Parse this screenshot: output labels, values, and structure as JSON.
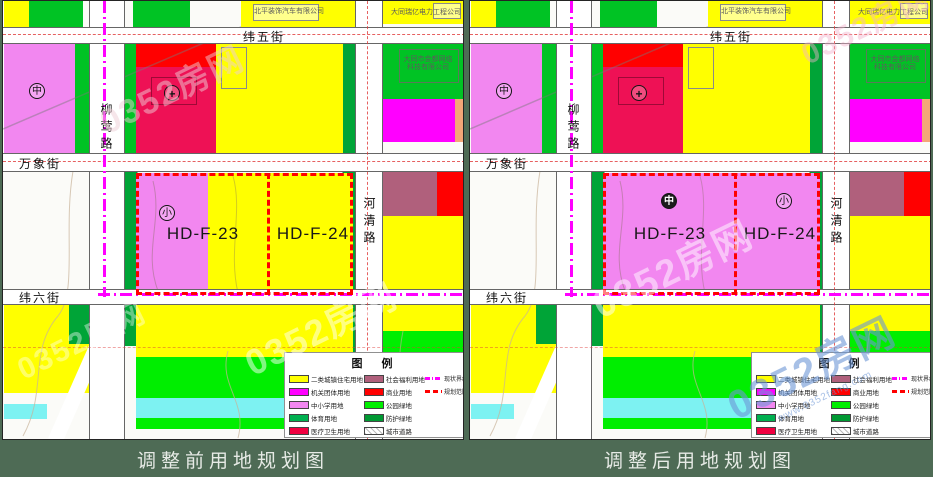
{
  "panels": [
    {
      "caption": "调整前用地规划图"
    },
    {
      "caption": "调整后用地规划图"
    }
  ],
  "streets": {
    "weiwu": "纬五街",
    "liuying": "柳莺路",
    "wanxiang": "万象街",
    "weiliu": "纬六街",
    "heqing": "河清路"
  },
  "plots": {
    "p23": "HD-F-23",
    "p24": "HD-F-24"
  },
  "symbols": {
    "middle_school": "中",
    "primary_school": "小",
    "hospital": "+"
  },
  "annotations": {
    "company_auto": "北平装饰汽车有限公司",
    "company_power": "大同瑞亿电力工程公司",
    "company_tech_line1": "大同市金都网络",
    "company_tech_line2": "科技有限公司"
  },
  "legend": {
    "title": "图 例",
    "items": [
      {
        "label": "二类城镇住宅用地",
        "color": "#ffff00"
      },
      {
        "label": "机关团体用地",
        "color": "#ff00ff"
      },
      {
        "label": "中小学用地",
        "color": "#f287f0"
      },
      {
        "label": "体育用地",
        "color": "#00b050"
      },
      {
        "label": "医疗卫生用地",
        "color": "#f00040"
      },
      {
        "label": "社会福利用地",
        "color": "#b0607c"
      },
      {
        "label": "商业用地",
        "color": "#ff0000"
      },
      {
        "label": "公园绿地",
        "color": "#00ee00"
      },
      {
        "label": "防护绿地",
        "color": "#009933"
      },
      {
        "label": "城市道路",
        "color": "#ffffff"
      }
    ],
    "lines": [
      {
        "label": "现状界线",
        "color": "#ff00ff",
        "style": "dash-dot"
      },
      {
        "label": "规划范围",
        "color": "#ff0000",
        "style": "dashed"
      }
    ]
  },
  "watermark": {
    "brand": "0352房网",
    "url": "www.0352fang.com"
  },
  "colors": {
    "residential": "#ffff00",
    "institution": "#ff00ff",
    "school": "#f287f0",
    "sports": "#00b050",
    "medical": "#ee1155",
    "welfare": "#b0607c",
    "commercial": "#ff0000",
    "park": "#00ee00",
    "buffer": "#009933",
    "water": "#7df2f2",
    "caption_bg": "#4e6b55"
  }
}
